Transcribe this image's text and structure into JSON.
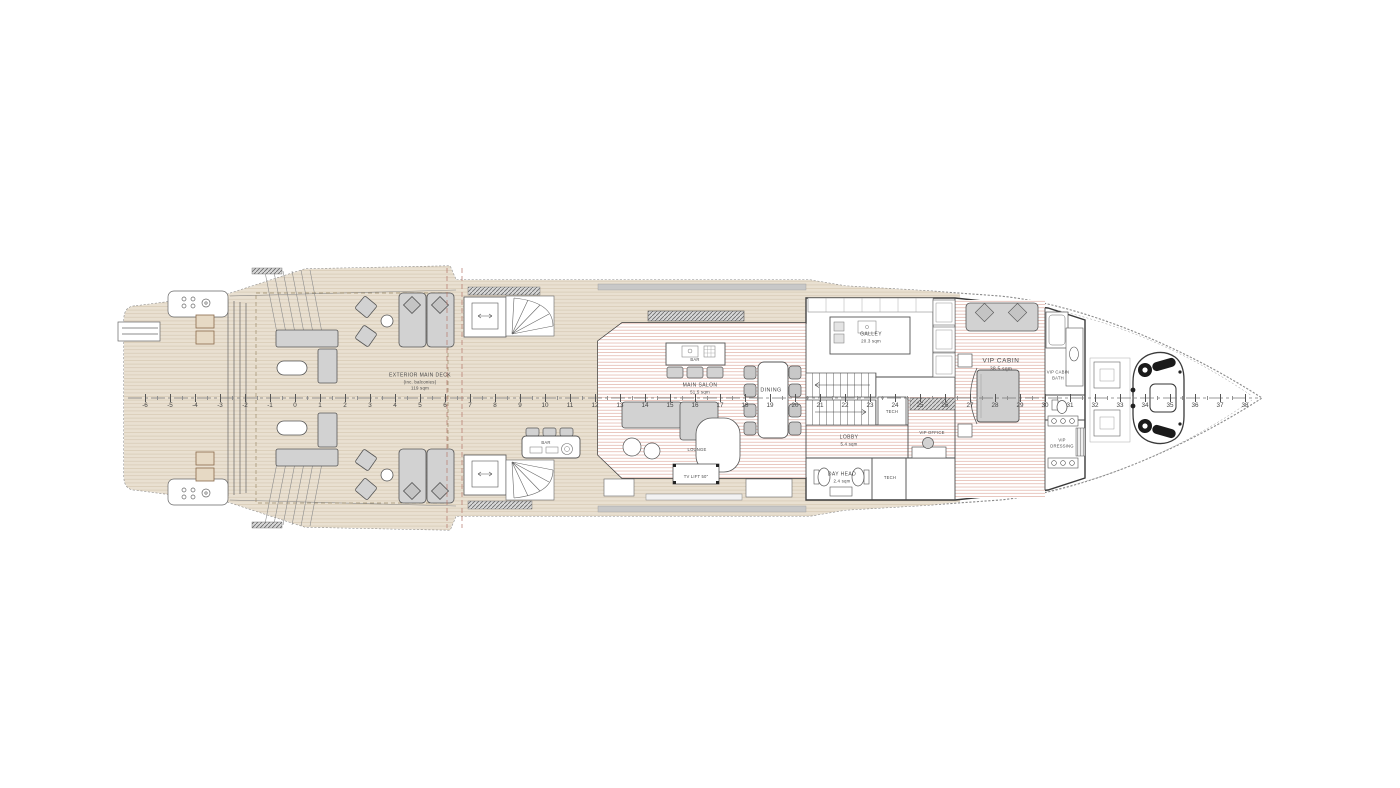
{
  "rooms": {
    "exterior_main_deck": {
      "lines": [
        "EXTERIOR MAIN DECK",
        "(inc. balconies)",
        "119 sqm"
      ]
    },
    "exterior_bar": {
      "lines": [
        "BAR"
      ]
    },
    "salon_bar": {
      "lines": [
        "BAR"
      ]
    },
    "main_salon": {
      "lines": [
        "MAIN SALON",
        "51.5 sqm"
      ]
    },
    "lounge": {
      "lines": [
        "LOUNGE"
      ]
    },
    "tv_lift": {
      "lines": [
        "TV LIFT 50\""
      ]
    },
    "dining": {
      "lines": [
        "DINING"
      ]
    },
    "galley": {
      "lines": [
        "GALLEY",
        "20.3 sqm"
      ]
    },
    "lobby": {
      "lines": [
        "LOBBY",
        "5.4 sqm"
      ]
    },
    "day_head": {
      "lines": [
        "DAY HEAD",
        "2.4 sqm"
      ]
    },
    "tech_upper": {
      "lines": [
        "TECH"
      ]
    },
    "tech_lower": {
      "lines": [
        "TECH"
      ]
    },
    "vip_office": {
      "lines": [
        "VIP OFFICE"
      ]
    },
    "vip_cabin": {
      "lines": [
        "VIP CABIN",
        "38.5 sqm"
      ]
    },
    "vip_cabin_bath": {
      "lines": [
        "VIP CABIN",
        "BATH"
      ]
    },
    "vip_dressing": {
      "lines": [
        "VIP",
        "DRESSING"
      ]
    }
  },
  "ruler": {
    "start": -6,
    "end": 38,
    "unit_px": 25,
    "zero_x": 295,
    "y": 398
  },
  "colors": {
    "deck_teak": "#e9e0d1",
    "teak_line": "#d6c9b4",
    "interior_stripe": "#d89a8d",
    "furniture": "#d2d2d2",
    "linework": "#555555",
    "balcony_gray": "#c8c8c8",
    "background": "#ffffff"
  }
}
